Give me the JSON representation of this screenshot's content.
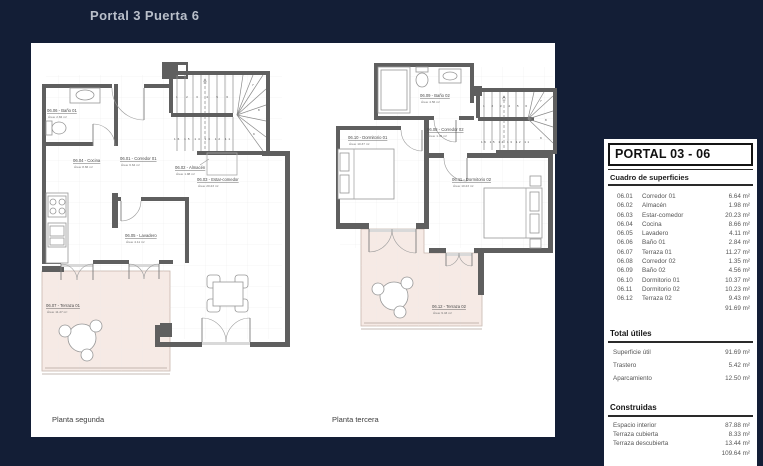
{
  "title": "Portal 3 Puerta 6",
  "plans": {
    "left": {
      "caption": "Planta segunda",
      "rooms": {
        "bano01": {
          "label": "06.06 - Baño 01",
          "area": "Área: 2.84 m²"
        },
        "cocina": {
          "label": "06.04 - Cocina",
          "area": "Área: 8.66 m²"
        },
        "corredor01": {
          "label": "06.01 - Corredor 01",
          "area": "Área: 6.64 m²"
        },
        "almacen": {
          "label": "06.02 - Almacén",
          "area": "Área: 1.98 m²"
        },
        "estar": {
          "label": "06.03 - Estar-comedor",
          "area": "Área: 20.23 m²"
        },
        "lavadero": {
          "label": "06.05 - Lavadero",
          "area": "Área: 4.11 m²"
        },
        "terraza01": {
          "label": "06.07 - Terraza 01",
          "area": "Área: 11.27 m²"
        }
      },
      "stairs": {
        "upper": "1 2 3 4 5 6",
        "lower": "16 15 14 13 12 11",
        "fan": [
          "7",
          "8",
          "9"
        ]
      }
    },
    "right": {
      "caption": "Planta tercera",
      "rooms": {
        "bano02": {
          "label": "06.09 - Baño 02",
          "area": "Área: 4.56 m²"
        },
        "dormitorio01": {
          "label": "06.10 - Dormitorio 01",
          "area": "Área: 10.37 m²"
        },
        "corredor02": {
          "label": "06.08 - Corredor 02",
          "area": "Área: 1.35 m²"
        },
        "dormitorio02": {
          "label": "06.11 - Dormitorio 02",
          "area": "Área: 10.23 m²"
        },
        "terraza02": {
          "label": "06.12 - Terraza 02",
          "area": "Área: 9.43 m²"
        }
      },
      "stairs": {
        "upper": "1 2 3 4 5 6",
        "lower": "16 15 14 13 12 11",
        "fan": [
          "7",
          "8",
          "9"
        ]
      }
    }
  },
  "panel": {
    "title": "PORTAL 03 - 06",
    "subtitle": "Cuadro de superficies",
    "rows": [
      {
        "code": "06.01",
        "name": "Corredor 01",
        "value": "6.64 m²"
      },
      {
        "code": "06.02",
        "name": "Almacén",
        "value": "1.98 m²"
      },
      {
        "code": "06.03",
        "name": "Estar-comedor",
        "value": "20.23 m²"
      },
      {
        "code": "06.04",
        "name": "Cocina",
        "value": "8.66 m²"
      },
      {
        "code": "06.05",
        "name": "Lavadero",
        "value": "4.11 m²"
      },
      {
        "code": "06.06",
        "name": "Baño 01",
        "value": "2.84 m²"
      },
      {
        "code": "06.07",
        "name": "Terraza 01",
        "value": "11.27 m²"
      },
      {
        "code": "06.08",
        "name": "Corredor 02",
        "value": "1.35 m²"
      },
      {
        "code": "06.09",
        "name": "Baño 02",
        "value": "4.56 m²"
      },
      {
        "code": "06.10",
        "name": "Dormitorio 01",
        "value": "10.37 m²"
      },
      {
        "code": "06.11",
        "name": "Dormitorio 02",
        "value": "10.23 m²"
      },
      {
        "code": "06.12",
        "name": "Terraza 02",
        "value": "9.43 m²"
      }
    ],
    "rows_total": "91.69 m²",
    "totales": {
      "title": "Total útiles",
      "rows": [
        {
          "name": "Superficie útil",
          "value": "91.69 m²"
        },
        {
          "name": "Trastero",
          "value": "5.42 m²"
        },
        {
          "name": "Aparcamiento",
          "value": "12.50 m²"
        }
      ]
    },
    "construidas": {
      "title": "Construidas",
      "rows": [
        {
          "name": "Espacio interior",
          "value": "87.88 m²"
        },
        {
          "name": "Terraza cubierta",
          "value": "8.33 m²"
        },
        {
          "name": "Terraza descubierta",
          "value": "13.44 m²"
        }
      ],
      "total": "109.64 m²"
    }
  },
  "colors": {
    "background": "#131e36",
    "sheet": "#ffffff",
    "wall": "#5f5f5f",
    "terrace": "#f6eae5",
    "title_text": "#b9bfca"
  }
}
